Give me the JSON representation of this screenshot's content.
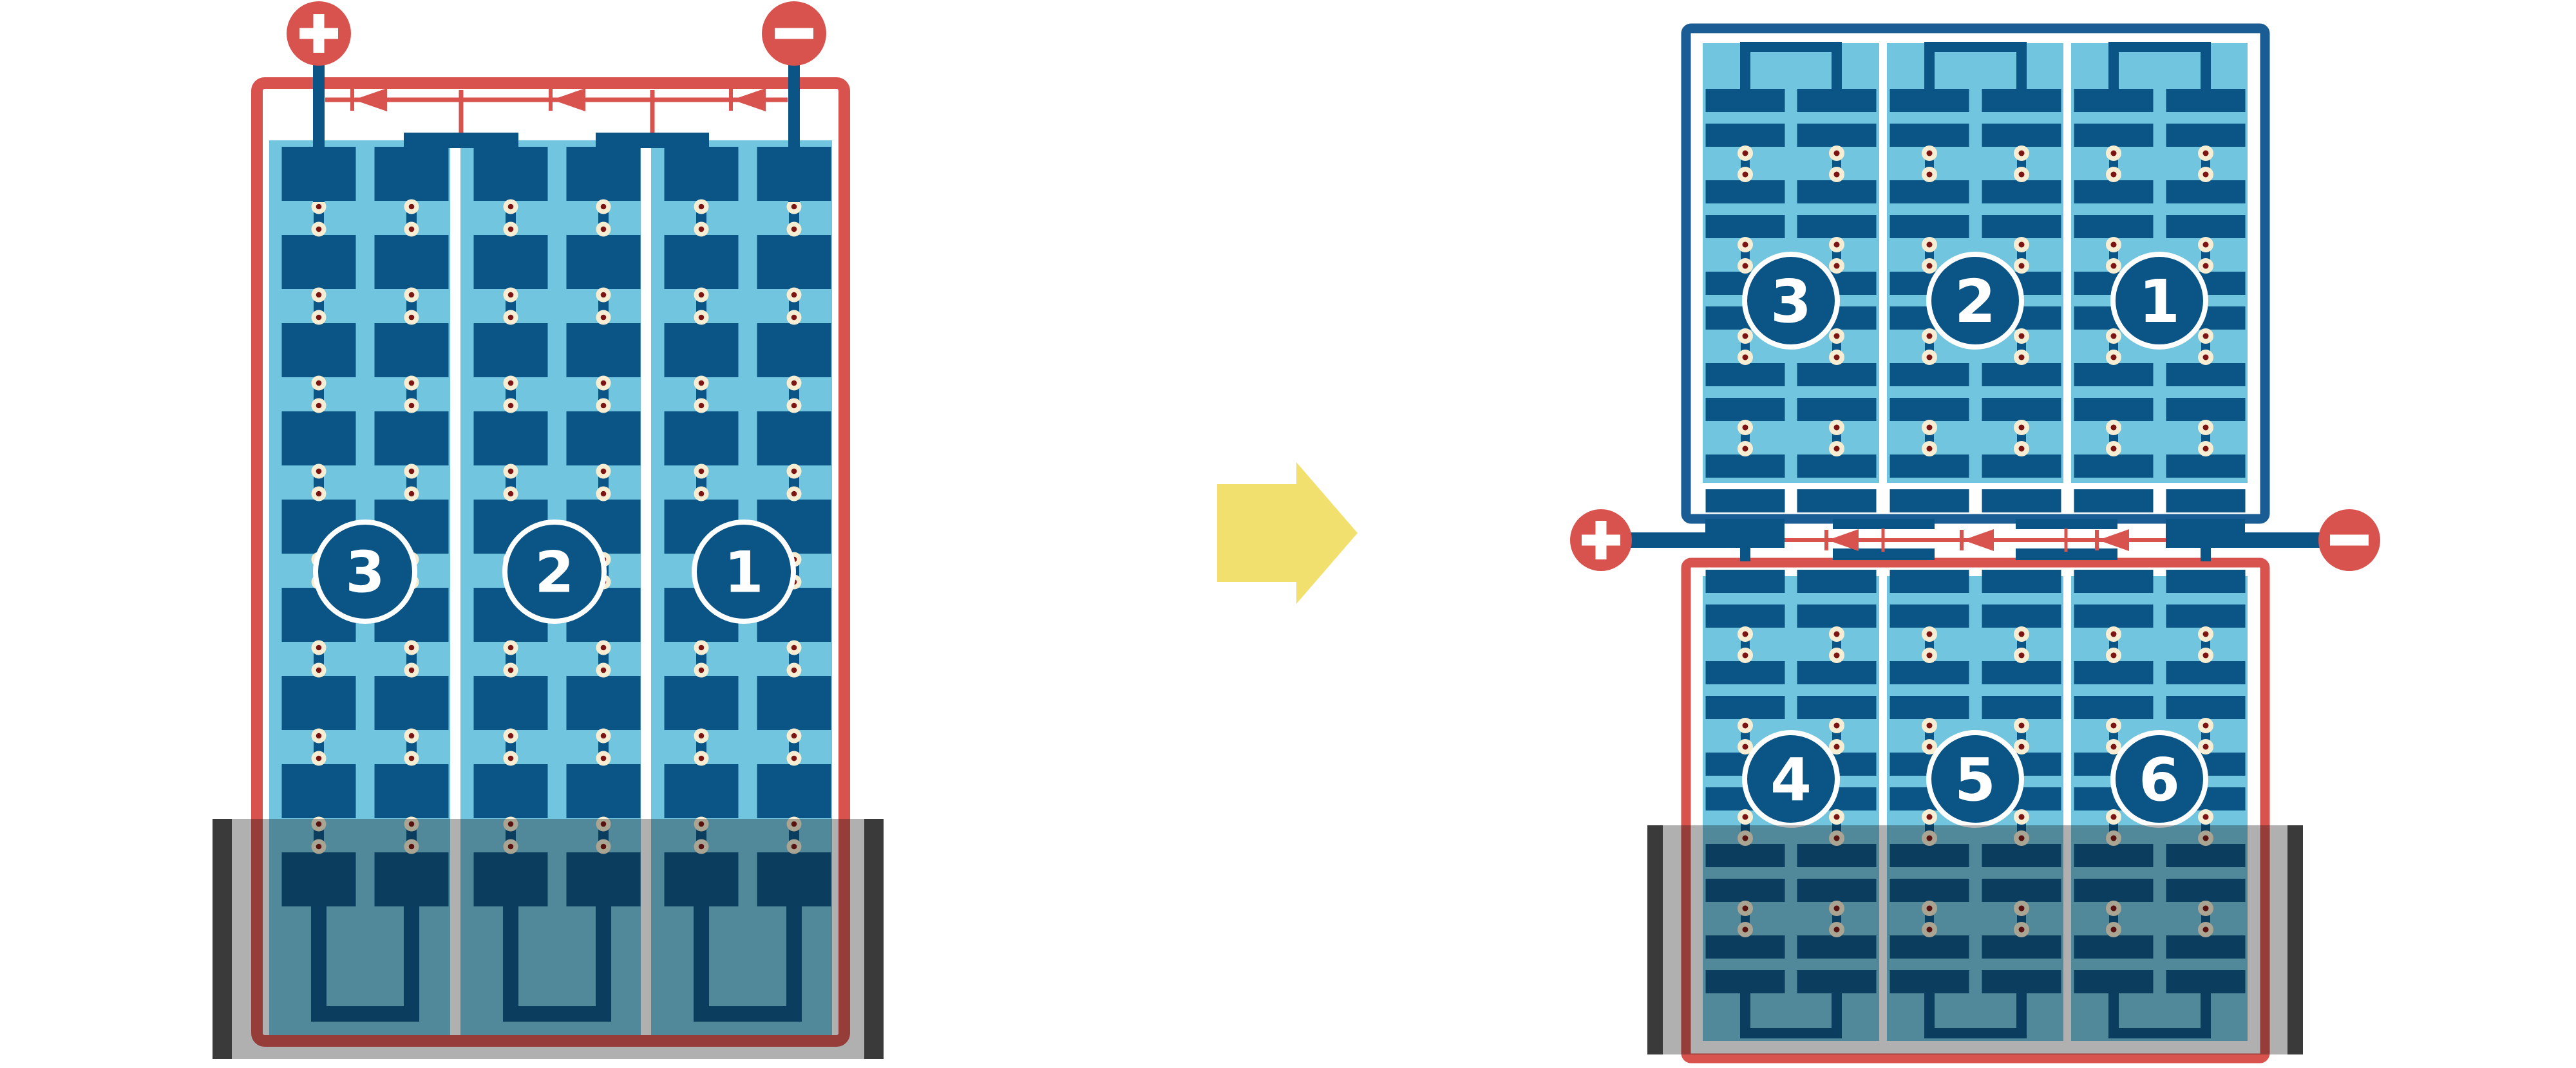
{
  "colors": {
    "background": "#FFFFFF",
    "case_red": "#D9534E",
    "case_blue": "#1A5C94",
    "plate_navy": "#0A5585",
    "electrolyte_blue": "#72C5DE",
    "separator_white": "#FFFFFF",
    "rivet_outer": "#F6EDD2",
    "rivet_inner": "#7D1414",
    "wire_red": "#D9534E",
    "terminal_red": "#D9534E",
    "terminal_sign_white": "#FFFFFF",
    "label_circle_fill": "#0A5585",
    "label_circle_stroke": "#FFFFFF",
    "label_text": "#FFFFFF",
    "holder_shade": "rgba(15,15,15,0.33)",
    "holder_cap": "#3A3A3A",
    "transform_arrow_yellow": "#F2E06E"
  },
  "left_battery": {
    "cells": [
      {
        "label": "3"
      },
      {
        "label": "2"
      },
      {
        "label": "1"
      }
    ],
    "terminals": [
      {
        "sign": "+",
        "polarity": "positive"
      },
      {
        "sign": "−",
        "polarity": "negative"
      }
    ],
    "plate_rows": 9,
    "plate_columns_per_cell": 2,
    "current_arrow_count": 3,
    "has_holder": true
  },
  "transform_arrow": {
    "direction": "right"
  },
  "right_stack": {
    "top_battery": {
      "flipped": true,
      "cells": [
        {
          "label": "3"
        },
        {
          "label": "2"
        },
        {
          "label": "1"
        }
      ],
      "plate_rows": 10
    },
    "bottom_battery": {
      "cells": [
        {
          "label": "4"
        },
        {
          "label": "5"
        },
        {
          "label": "6"
        }
      ],
      "plate_rows": 10,
      "has_holder": true
    },
    "terminals": [
      {
        "sign": "+",
        "polarity": "positive"
      },
      {
        "sign": "−",
        "polarity": "negative"
      }
    ],
    "current_arrow_count": 3
  }
}
